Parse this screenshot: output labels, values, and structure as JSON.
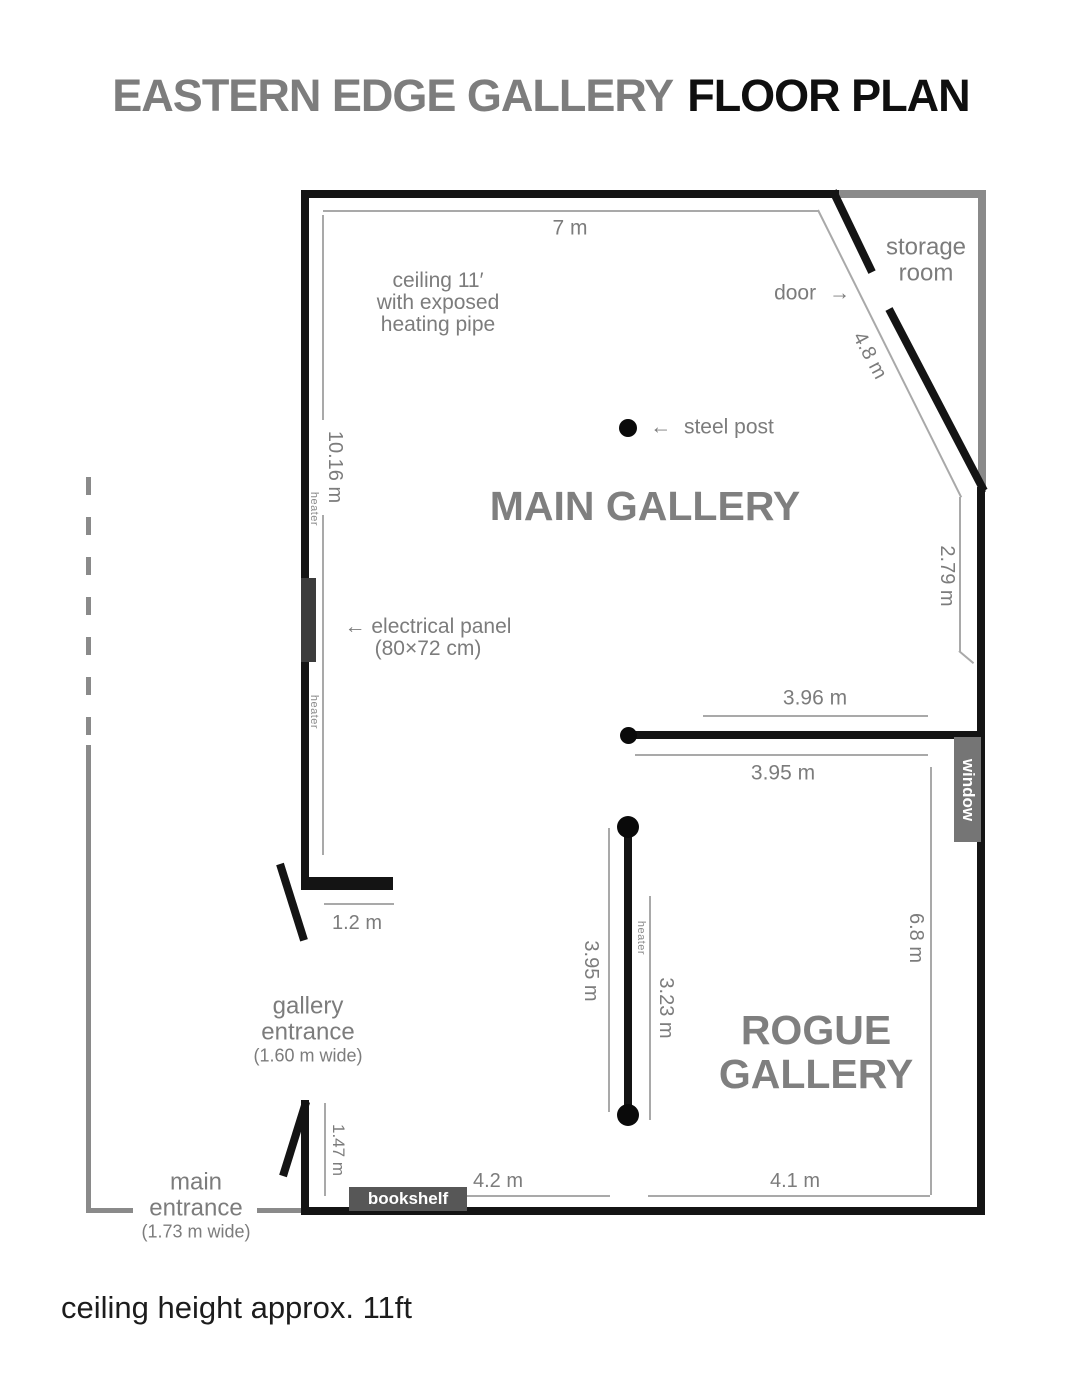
{
  "title": {
    "gallery": "EASTERN EDGE GALLERY",
    "suffix": "FLOOR PLAN"
  },
  "caption": "ceiling height approx. 11ft",
  "rooms": {
    "main": "MAIN GALLERY",
    "rogue_line1": "ROGUE",
    "rogue_line2": "GALLERY",
    "storage_line1": "storage",
    "storage_line2": "room"
  },
  "annotations": {
    "ceiling_note": [
      "ceiling 11′",
      "with exposed",
      "heating pipe"
    ],
    "door": "door",
    "steel_post": "steel post",
    "electrical_panel": "electrical panel",
    "electrical_panel_size": "(80×72 cm)",
    "window": "window",
    "bookshelf": "bookshelf",
    "heater": "heater",
    "gallery_entrance_line1": "gallery",
    "gallery_entrance_line2": "entrance",
    "gallery_entrance_width": "(1.60 m wide)",
    "main_entrance_line1": "main",
    "main_entrance_line2": "entrance",
    "main_entrance_width": "(1.73 m wide)"
  },
  "icons": {
    "left_arrow": "←",
    "right_arrow": "→"
  },
  "dimensions": {
    "top": "7 m",
    "left": "10.16 m",
    "diagonal": "4.8 m",
    "right_upper": "2.79 m",
    "divider_above": "3.96 m",
    "divider_below": "3.95 m",
    "rogue_heater_left": "3.95 m",
    "rogue_heater_right": "3.23 m",
    "rogue_right": "6.8 m",
    "rogue_bottom": "4.1 m",
    "stub": "1.2 m",
    "entry_depth": "1.47 m",
    "bottom_left": "4.2 m"
  }
}
